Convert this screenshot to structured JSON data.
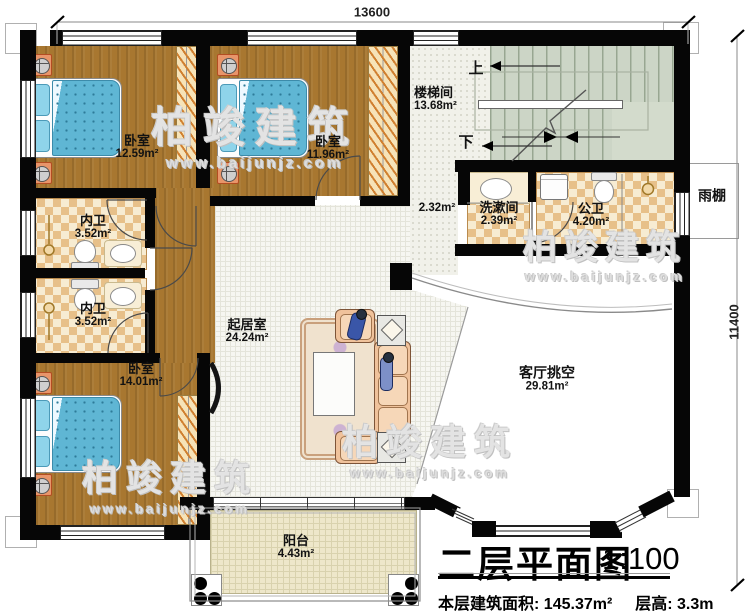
{
  "plan": {
    "dimension_top": "13600",
    "dimension_right": "11400",
    "rooms": {
      "bedroom1": {
        "name": "卧室",
        "area": "12.59m²"
      },
      "bedroom2": {
        "name": "卧室",
        "area": "11.96m²"
      },
      "bedroom3": {
        "name": "卧室",
        "area": "14.01m²"
      },
      "stair_hall": {
        "name": "楼梯间",
        "area": "13.68m²"
      },
      "hall": {
        "area": "2.32m²"
      },
      "washroom": {
        "name": "洗漱间",
        "area": "2.39m²"
      },
      "public_bath": {
        "name": "公卫",
        "area": "4.20m²"
      },
      "ensuite1": {
        "name": "内卫",
        "area": "3.52m²"
      },
      "ensuite2": {
        "name": "内卫",
        "area": "3.52m²"
      },
      "living": {
        "name": "起居室",
        "area": "24.24m²"
      },
      "living_void": {
        "name": "客厅挑空",
        "area": "29.81m²"
      },
      "balcony": {
        "name": "阳台",
        "area": "4.43m²"
      },
      "canopy": {
        "name": "雨棚"
      }
    },
    "stairs": {
      "up": "上",
      "down": "下"
    }
  },
  "title_block": {
    "title": "二层平面图",
    "scale": "1:100",
    "area_label": "本层建筑面积:",
    "area_value": "145.37m²",
    "height_label": "层高:",
    "height_value": "3.3m"
  },
  "watermark": {
    "brand": "柏竣建筑",
    "url": "www.baijunjz.com"
  },
  "palette": {
    "wall": "#060606",
    "wood": "#a87730",
    "bed_blue": "#5fb6d4",
    "tile_tan": "#e7c089",
    "stair_green": "#ccd5c6",
    "furniture_orange": "#e8956a"
  }
}
